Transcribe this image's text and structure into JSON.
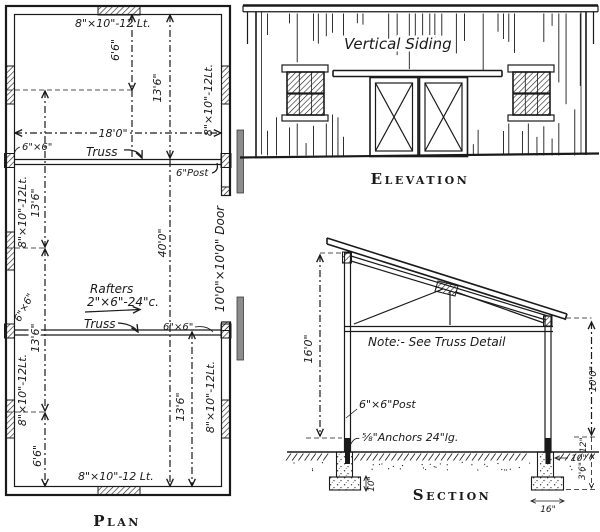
{
  "colors": {
    "ink": "#1a1a1a",
    "paper": "#ffffff",
    "gray": "#8c8c8c"
  },
  "plan": {
    "title": "Plan",
    "windows": {
      "top": "8\"×10\"-12 Lt.",
      "bottom": "8\"×10\"-12 Lt.",
      "left_upper": "8\"×10\"-12Lt.",
      "left_lower": "8\"×10\"-12Lt.",
      "right_upper": "8\"×10\"-12Lt.",
      "right_lower": "8\"×10\"-12Lt."
    },
    "dims": {
      "d66_top": "6'6\"",
      "d136_right_top": "13'6\"",
      "d180": "18'0\"",
      "d400": "40'0\"",
      "d136_left_upper": "13'6\"",
      "d136_left_lower": "13'6\"",
      "d66_bottom": "6'6\"",
      "d136_right_bottom": "13'6\""
    },
    "truss_upper": "Truss",
    "truss_lower": "Truss",
    "post_66_upper_left": "6\"×6\"",
    "post_66_lower_left": "6\"×6\"",
    "post_66_lower_right": "6\"×6\"",
    "post_6_upper_right": "6\"Post",
    "rafters_line1": "Rafters",
    "rafters_line2": "2\"×6\"-24\"c.",
    "door": "10'0\"×10'0\" Door"
  },
  "elevation": {
    "title": "Elevation",
    "siding_label": "Vertical Siding"
  },
  "section": {
    "title": "Section",
    "note": "Note:- See Truss Detail",
    "post_label": "6\"×6\"Post",
    "anchor_label": "⅝\"Anchors 24\"lg.",
    "dims": {
      "d160": "16'0\"",
      "d100": "10'0\"",
      "d12": "12\"",
      "d10_right": "10\"",
      "d36": "3'6\"",
      "d16": "16\"",
      "d10_left": "10\""
    }
  }
}
